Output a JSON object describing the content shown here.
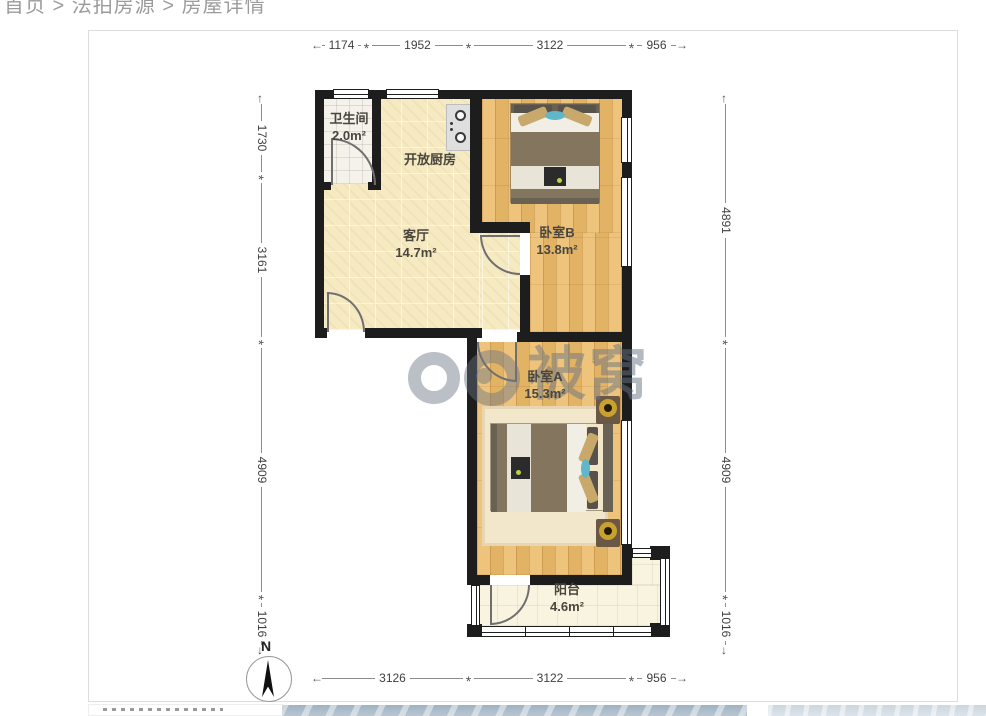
{
  "breadcrumb": {
    "path": "首页 > 法拍房源 > 房屋详情"
  },
  "floorplan": {
    "rooms": {
      "bathroom": {
        "name": "卫生间",
        "area": "2.0m²"
      },
      "kitchen": {
        "name": "开放厨房",
        "area": ""
      },
      "living": {
        "name": "客厅",
        "area": "14.7m²"
      },
      "bedroomB": {
        "name": "卧室B",
        "area": "13.8m²"
      },
      "bedroomA": {
        "name": "卧室A",
        "area": "15.3m²"
      },
      "balcony": {
        "name": "阳台",
        "area": "4.6m²"
      }
    },
    "dims": {
      "top": [
        "1174",
        "1952",
        "3122",
        "956"
      ],
      "bottom": [
        "3126",
        "3122",
        "956"
      ],
      "left": [
        "1730",
        "3161",
        "4909",
        "1016"
      ],
      "right": [
        "4891",
        "4909",
        "1016"
      ]
    },
    "compass_label": "N",
    "watermark_text": "被窝",
    "palette": {
      "wall": "#1d1d1d",
      "wood_floor": "#ecbd6d",
      "tile_floor": "#f6eac3",
      "bathroom_floor": "#f4f2eb",
      "balcony_floor": "#f8f4df",
      "accent_teal": "#5fb7c9",
      "lamp_gold": "#c9a22e",
      "bed_blanket": "#84755f",
      "watermark_gray": "#687383",
      "dim_text": "#3f3f3f",
      "breadcrumb_gray": "#9b9b9b"
    }
  }
}
